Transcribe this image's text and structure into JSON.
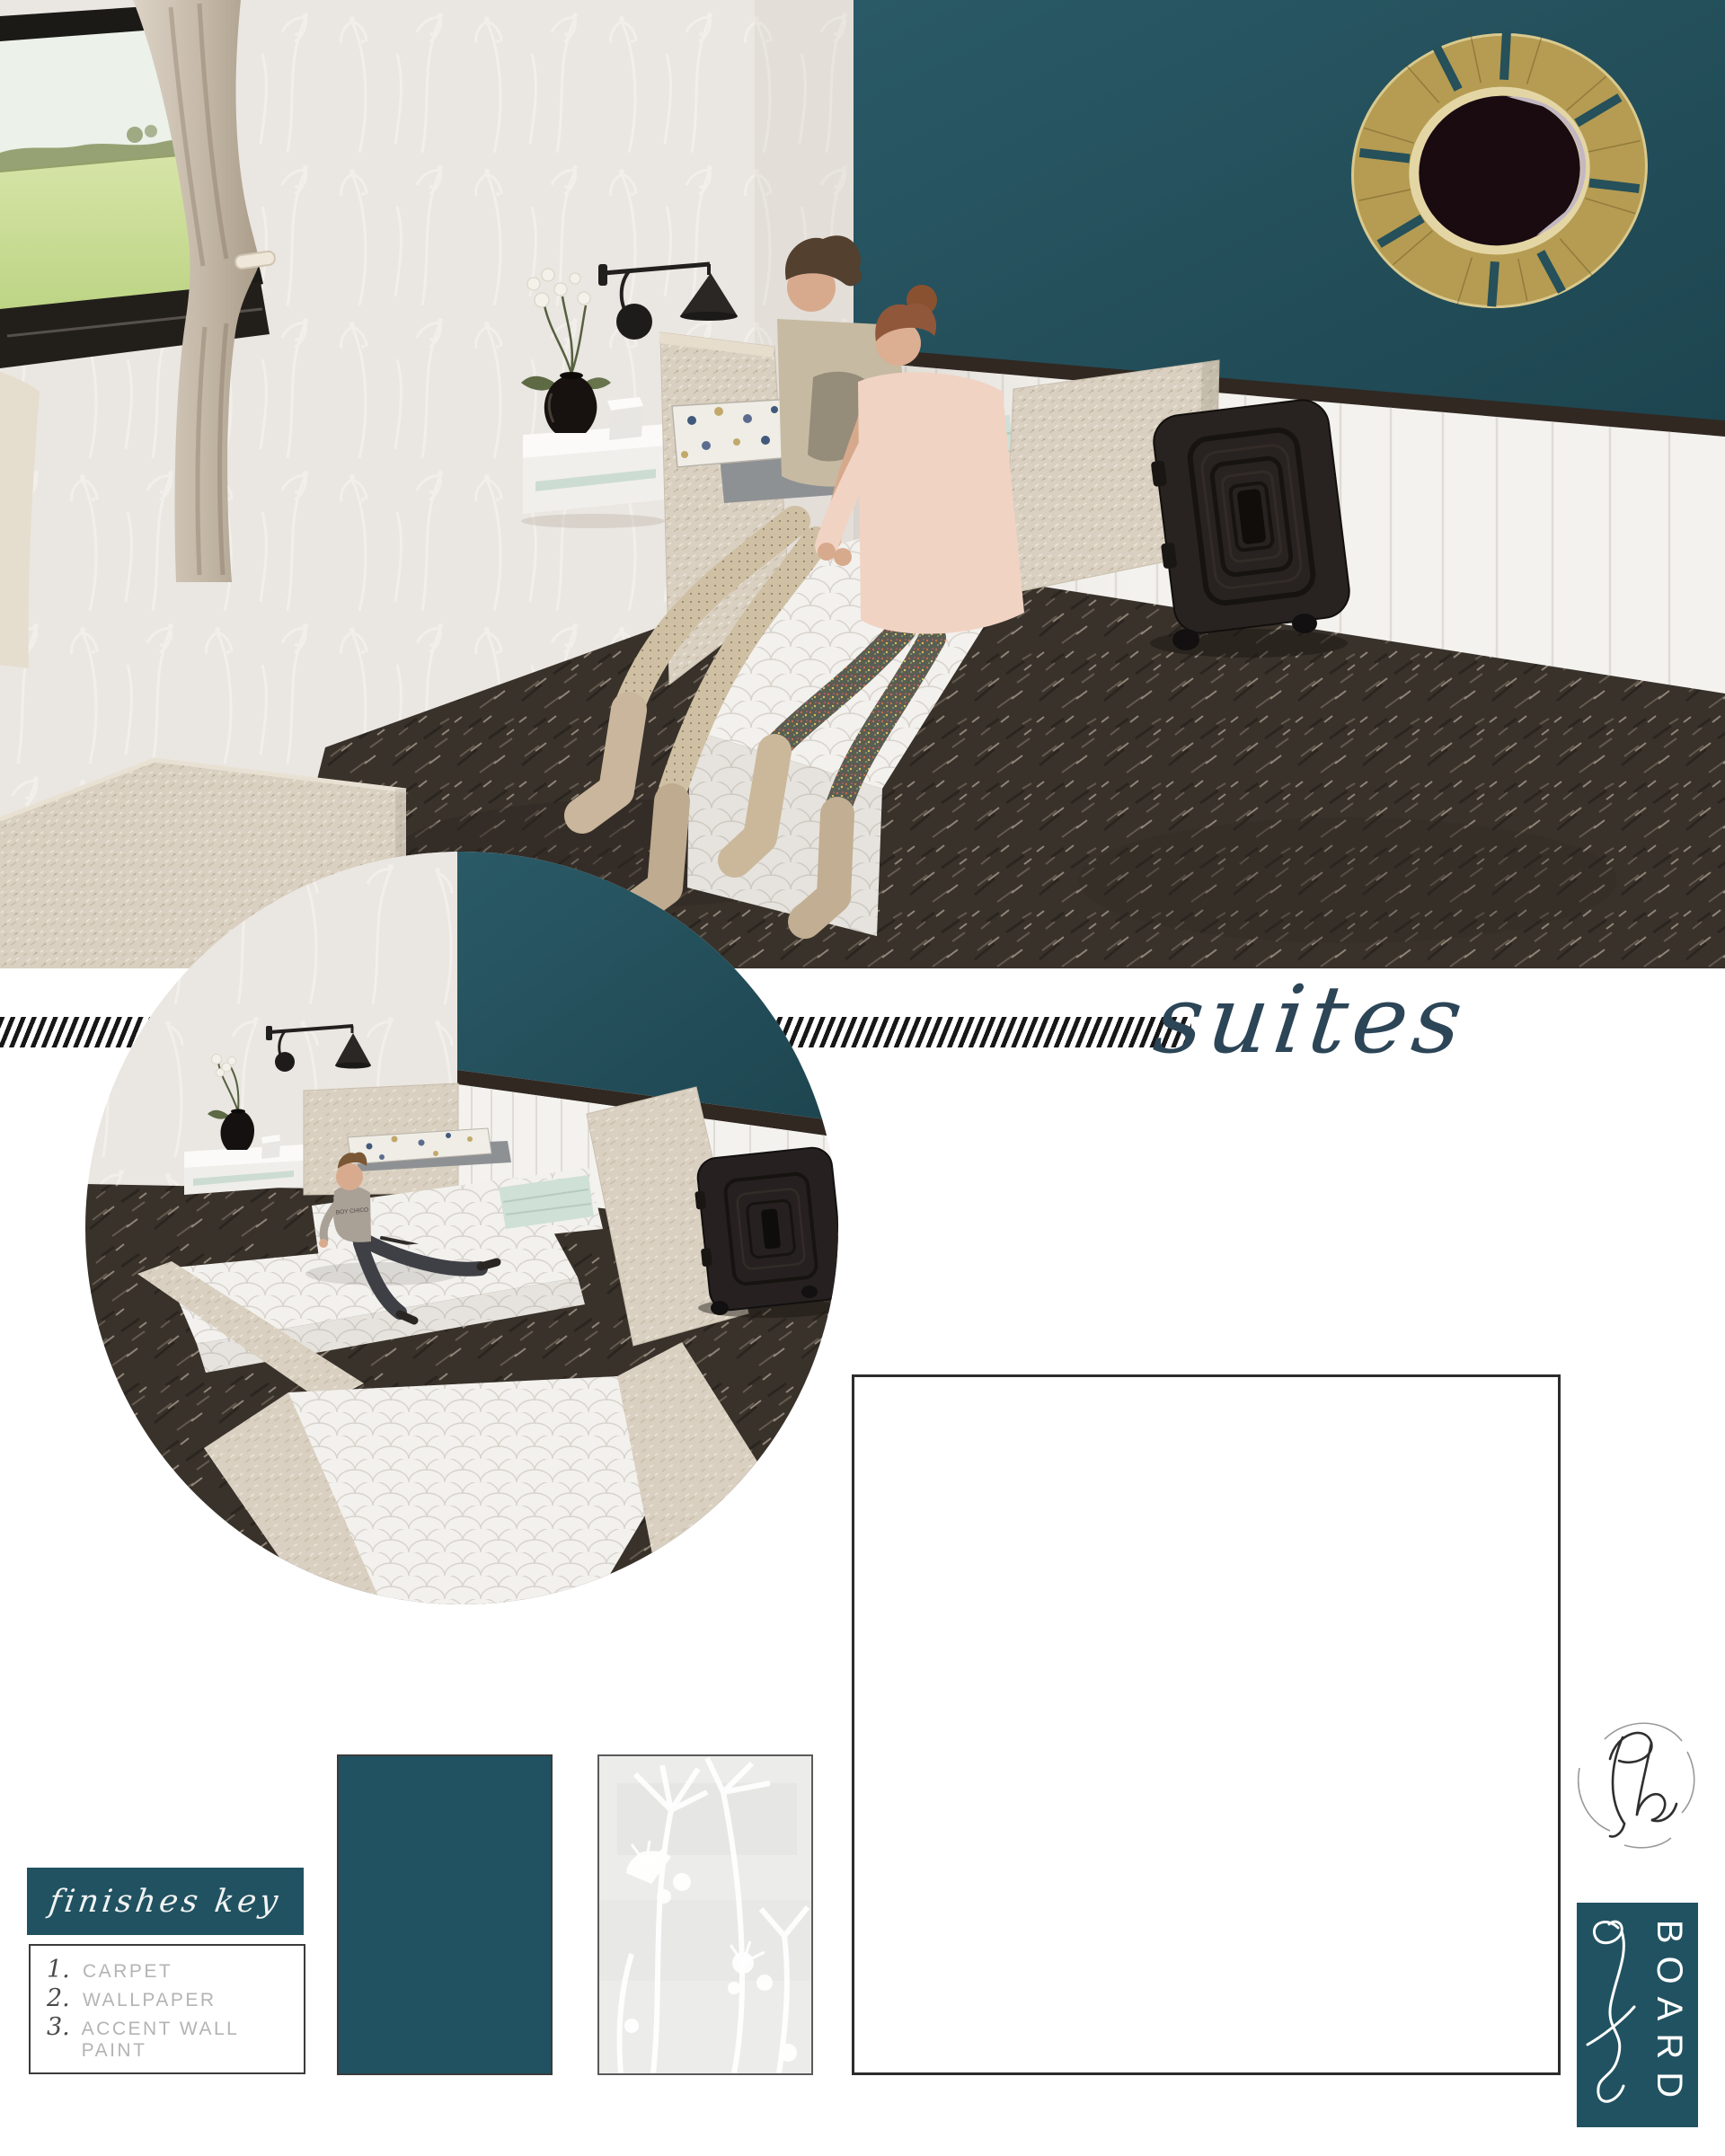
{
  "board": {
    "divider_label": "suites",
    "finishes_key": {
      "title": "finishes key",
      "items": [
        {
          "num": "1.",
          "label": "CARPET"
        },
        {
          "num": "2.",
          "label": "WALLPAPER"
        },
        {
          "num": "3.",
          "label": "ACCENT WALL PAINT"
        }
      ]
    },
    "logo_label": "BOARD",
    "inset_tshirt_text": "BOY CHICO",
    "colors": {
      "accent_teal": "#215261",
      "wall_teal": "#24505a",
      "trim_dark": "#312822",
      "carpet_dark": "#39322b",
      "mint": "#cfe0d6",
      "mirror_gold": "#b59c52",
      "script_ink": "#2c4557"
    }
  }
}
